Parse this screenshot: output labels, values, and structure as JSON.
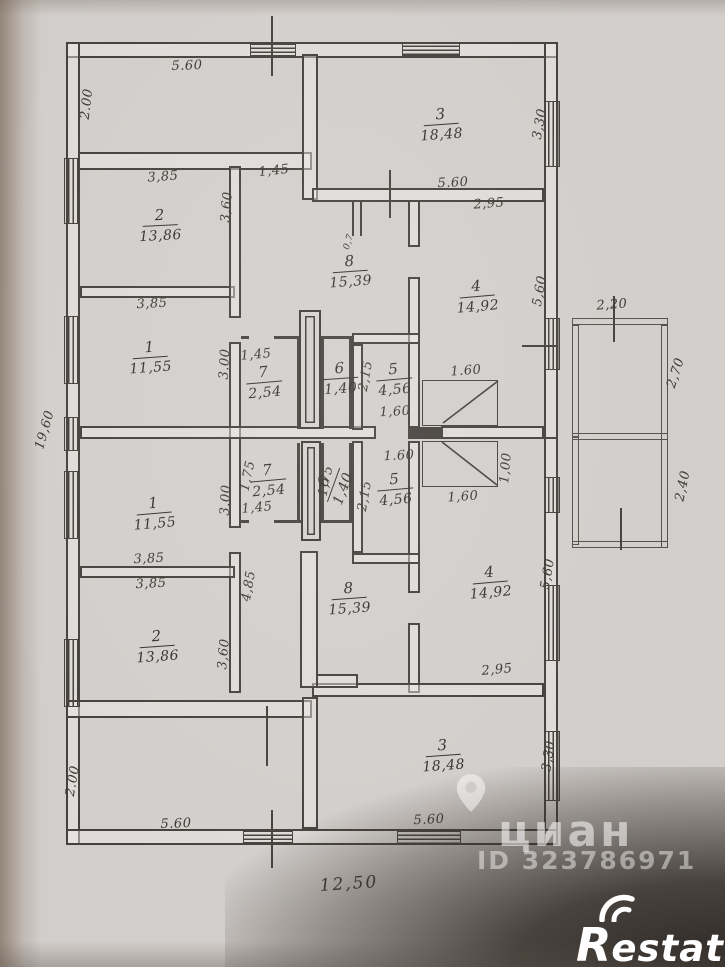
{
  "rooms": [
    {
      "number": "2",
      "area": "13,86",
      "x": 160,
      "y": 225,
      "rot": -3
    },
    {
      "number": "1",
      "area": "11,55",
      "x": 150,
      "y": 357,
      "rot": -4
    },
    {
      "number": "3",
      "area": "18,48",
      "x": 441,
      "y": 124,
      "rot": -4
    },
    {
      "number": "4",
      "area": "14,92",
      "x": 477,
      "y": 296,
      "rot": -5
    },
    {
      "number": "8",
      "area": "15,39",
      "x": 350,
      "y": 271,
      "rot": -4
    },
    {
      "number": "7",
      "area": "2,54",
      "x": 264,
      "y": 382,
      "rot": -5
    },
    {
      "number": "6",
      "area": "1,40",
      "x": 340,
      "y": 378,
      "rot": -4
    },
    {
      "number": "5",
      "area": "4,56",
      "x": 394,
      "y": 379,
      "rot": -5
    },
    {
      "number": "1",
      "area": "11,55",
      "x": 154,
      "y": 513,
      "rot": -5
    },
    {
      "number": "2",
      "area": "13,86",
      "x": 157,
      "y": 646,
      "rot": -4
    },
    {
      "number": "7",
      "area": "2,54",
      "x": 268,
      "y": 480,
      "rot": -5
    },
    {
      "number": "6",
      "area": "1,40",
      "x": 333,
      "y": 485,
      "rot": -70
    },
    {
      "number": "5",
      "area": "4,56",
      "x": 395,
      "y": 489,
      "rot": -5
    },
    {
      "number": "8",
      "area": "15,39",
      "x": 349,
      "y": 598,
      "rot": -4
    },
    {
      "number": "4",
      "area": "14,92",
      "x": 490,
      "y": 582,
      "rot": -5
    },
    {
      "number": "3",
      "area": "18,48",
      "x": 443,
      "y": 755,
      "rot": -4
    }
  ],
  "dimensions": [
    {
      "text": "5.60",
      "x": 187,
      "y": 66,
      "rot": -2
    },
    {
      "text": "2.00",
      "x": 87,
      "y": 104,
      "rot": -83
    },
    {
      "text": "3,85",
      "x": 163,
      "y": 177,
      "rot": -4
    },
    {
      "text": "1,45",
      "x": 274,
      "y": 171,
      "rot": -6
    },
    {
      "text": "3,60",
      "x": 227,
      "y": 207,
      "rot": -85
    },
    {
      "text": "5.60",
      "x": 453,
      "y": 183,
      "rot": -3
    },
    {
      "text": "2,95",
      "x": 489,
      "y": 204,
      "rot": -4
    },
    {
      "text": "3,30",
      "x": 540,
      "y": 124,
      "rot": -80
    },
    {
      "text": "3,85",
      "x": 152,
      "y": 304,
      "rot": -3
    },
    {
      "text": "3.00",
      "x": 225,
      "y": 364,
      "rot": -87
    },
    {
      "text": "1,45",
      "x": 256,
      "y": 355,
      "rot": -5
    },
    {
      "text": "2,15",
      "x": 366,
      "y": 376,
      "rot": -80
    },
    {
      "text": "1,60",
      "x": 395,
      "y": 412,
      "rot": -3
    },
    {
      "text": "1.60",
      "x": 466,
      "y": 371,
      "rot": -4
    },
    {
      "text": "0,7",
      "x": 349,
      "y": 242,
      "rot": -72,
      "size": "small"
    },
    {
      "text": "19,60",
      "x": 45,
      "y": 430,
      "rot": -74
    },
    {
      "text": "2,20",
      "x": 612,
      "y": 305,
      "rot": -4
    },
    {
      "text": "2,70",
      "x": 676,
      "y": 373,
      "rot": -72
    },
    {
      "text": "2,40",
      "x": 683,
      "y": 486,
      "rot": -78
    },
    {
      "text": "5,60",
      "x": 540,
      "y": 291,
      "rot": -80
    },
    {
      "text": "1,75",
      "x": 248,
      "y": 476,
      "rot": -78
    },
    {
      "text": "1,45",
      "x": 257,
      "y": 508,
      "rot": -5
    },
    {
      "text": "3.00",
      "x": 226,
      "y": 500,
      "rot": -87
    },
    {
      "text": "4,85",
      "x": 249,
      "y": 586,
      "rot": -80
    },
    {
      "text": "3,85",
      "x": 149,
      "y": 559,
      "rot": -3
    },
    {
      "text": "3,85",
      "x": 151,
      "y": 584,
      "rot": -3
    },
    {
      "text": "3,60",
      "x": 224,
      "y": 654,
      "rot": -85
    },
    {
      "text": "1,75",
      "x": 326,
      "y": 481,
      "rot": -78
    },
    {
      "text": "2,15",
      "x": 365,
      "y": 496,
      "rot": -80
    },
    {
      "text": "1.60",
      "x": 399,
      "y": 456,
      "rot": -3
    },
    {
      "text": "1,60",
      "x": 463,
      "y": 497,
      "rot": -4
    },
    {
      "text": "1,00",
      "x": 506,
      "y": 468,
      "rot": -85
    },
    {
      "text": "5,60",
      "x": 548,
      "y": 574,
      "rot": -80
    },
    {
      "text": "2,95",
      "x": 497,
      "y": 670,
      "rot": -5
    },
    {
      "text": "5.60",
      "x": 429,
      "y": 820,
      "rot": -3
    },
    {
      "text": "3,30",
      "x": 549,
      "y": 756,
      "rot": -82
    },
    {
      "text": "2.00",
      "x": 73,
      "y": 781,
      "rot": -80
    },
    {
      "text": "5.60",
      "x": 176,
      "y": 824,
      "rot": -2
    },
    {
      "text": "12,50",
      "x": 349,
      "y": 884,
      "rot": -4,
      "size": "big"
    }
  ],
  "watermark": {
    "brand": "циан",
    "listing_id": "ID 323786971"
  },
  "logo": {
    "text": "Restate",
    "initial": "R",
    "rest": "estate"
  },
  "colors": {
    "paper": "#d2cecb",
    "line": "#45403c",
    "shadow": "#2f2a26",
    "watermark_text": "rgba(255,255,255,0.55)"
  }
}
